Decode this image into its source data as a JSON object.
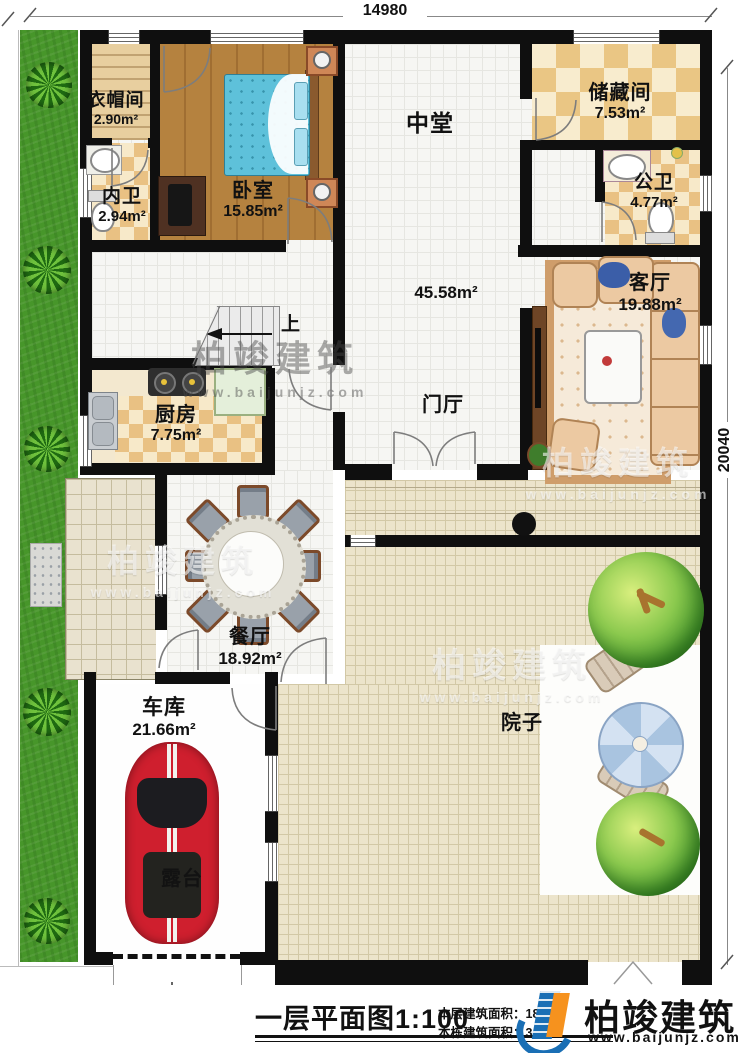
{
  "meta": {
    "plan_title": "一层平面图",
    "scale": "1:100",
    "floor_area_label": "本层建筑面积：",
    "floor_area_value": "18",
    "building_area_label": "本栋建筑面积：",
    "building_area_value": "34"
  },
  "dimensions": {
    "top": "14980",
    "right": "20040"
  },
  "rooms": {
    "wardrobe": {
      "name": "衣帽间",
      "area": "2.90m²"
    },
    "inner_bath": {
      "name": "内卫",
      "area": "2.94m²"
    },
    "bedroom": {
      "name": "卧室",
      "area": "15.85m²"
    },
    "hall": {
      "name": "中堂",
      "area": "45.58m²"
    },
    "storage": {
      "name": "储藏间",
      "area": "7.53m²"
    },
    "public_bath": {
      "name": "公卫",
      "area": "4.77m²"
    },
    "living": {
      "name": "客厅",
      "area": "19.88m²"
    },
    "kitchen": {
      "name": "厨房",
      "area": "7.75m²"
    },
    "foyer": {
      "name": "门厅"
    },
    "dining": {
      "name": "餐厅",
      "area": "18.92m²"
    },
    "garage": {
      "name": "车库",
      "area": "21.66m²"
    },
    "terrace": {
      "name": "露台"
    },
    "yard": {
      "name": "院子"
    }
  },
  "stairs": {
    "up_label": "上"
  },
  "watermark": {
    "brand": "柏竣建筑",
    "url": "www.baijunjz.com"
  },
  "logo": {
    "brand": "柏竣建筑",
    "url": "www.baijunjz.com"
  }
}
